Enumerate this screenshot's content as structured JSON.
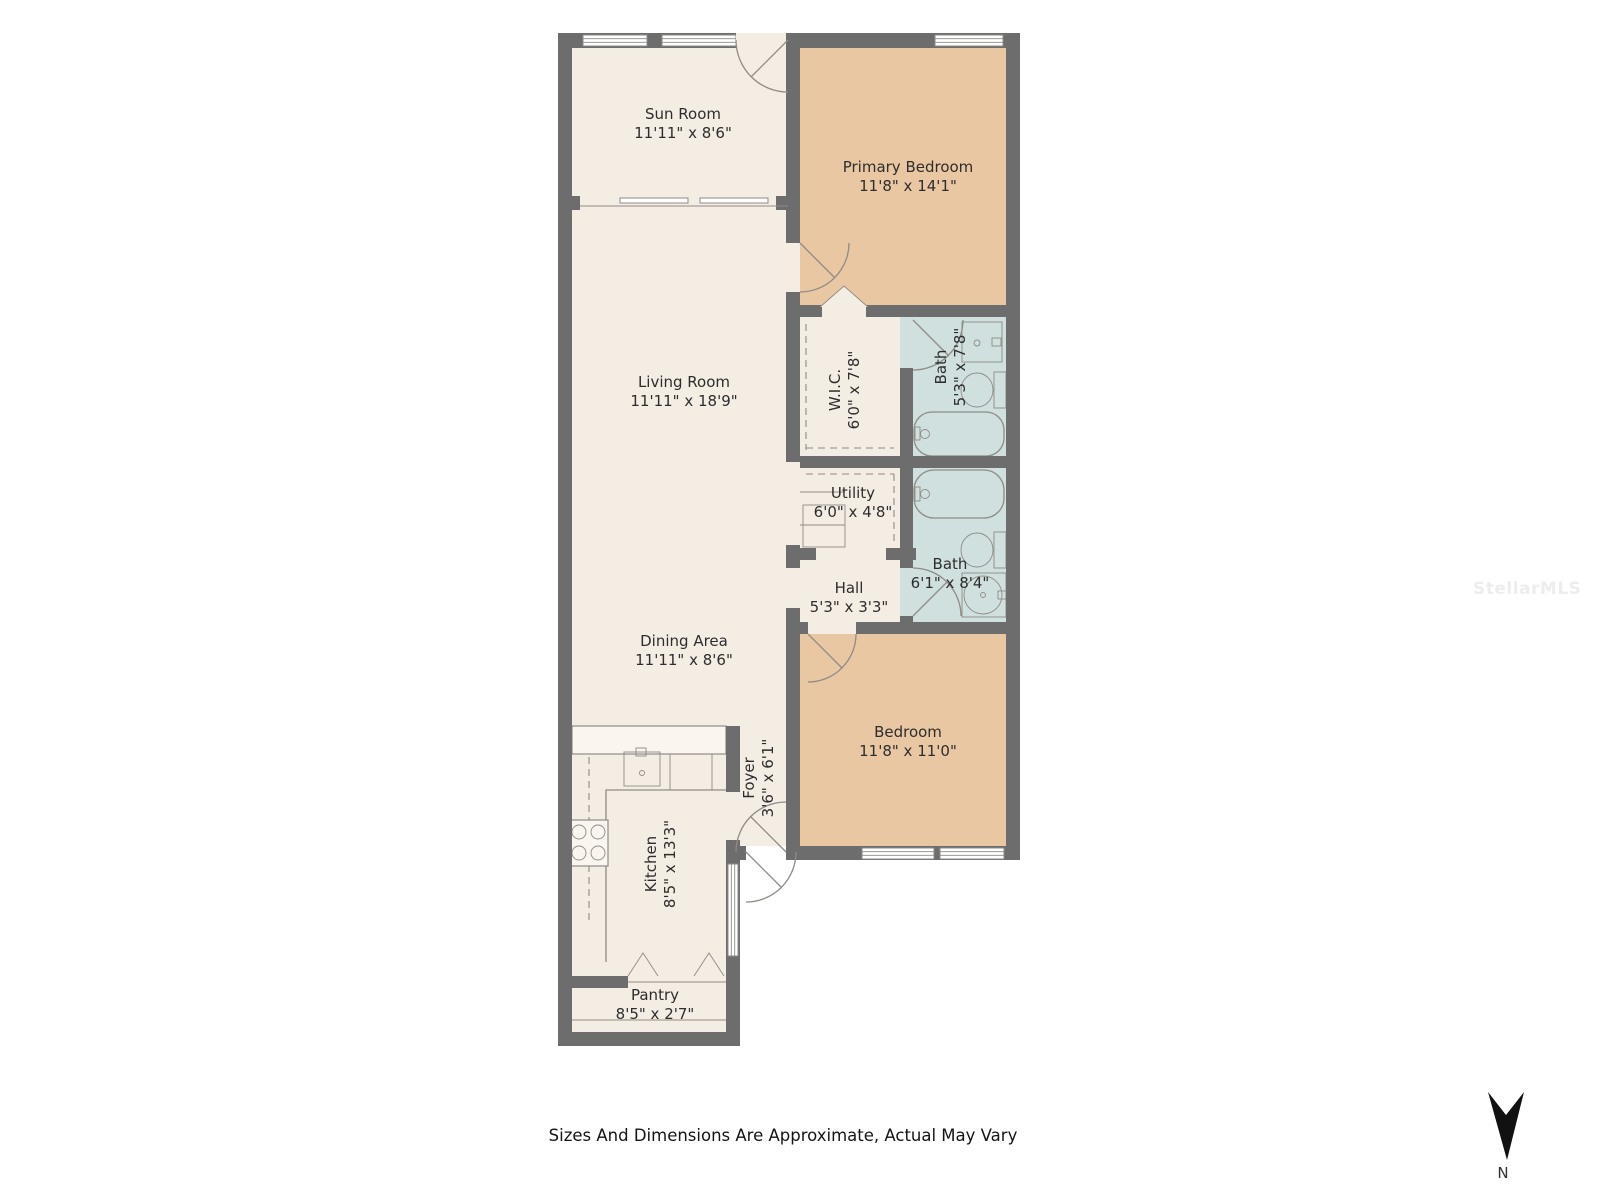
{
  "colors": {
    "wall": "#6d6d6d",
    "floor": "#f4ede4",
    "bedroom_floor": "#eac7a3",
    "bath_floor": "#cfe0df",
    "counter": "#faf5ee",
    "line": "#8f8b86",
    "text": "#2d2d2d",
    "watermark": "#ededed",
    "north": "#111111"
  },
  "rooms": [
    {
      "name": "Sun Room",
      "dims": "11'11\" x 8'6\""
    },
    {
      "name": "Primary Bedroom",
      "dims": "11'8\" x 14'1\""
    },
    {
      "name": "Living Room",
      "dims": "11'11\" x 18'9\""
    },
    {
      "name": "W.I.C.",
      "dims": "6'0\" x 7'8\""
    },
    {
      "name": "Bath",
      "dims": "5'3\" x 7'8\""
    },
    {
      "name": "Utility",
      "dims": "6'0\" x 4'8\""
    },
    {
      "name": "Bath",
      "dims": "6'1\" x 8'4\""
    },
    {
      "name": "Hall",
      "dims": "5'3\" x 3'3\""
    },
    {
      "name": "Dining Area",
      "dims": "11'11\" x 8'6\""
    },
    {
      "name": "Bedroom",
      "dims": "11'8\" x 11'0\""
    },
    {
      "name": "Foyer",
      "dims": "3'6\" x 6'1\""
    },
    {
      "name": "Kitchen",
      "dims": "8'5\" x 13'3\""
    },
    {
      "name": "Pantry",
      "dims": "8'5\" x 2'7\""
    }
  ],
  "footer": {
    "disclaimer": "Sizes And Dimensions Are Approximate, Actual May Vary"
  },
  "compass": {
    "label": "N"
  },
  "watermark": {
    "text": "StellarMLS"
  }
}
